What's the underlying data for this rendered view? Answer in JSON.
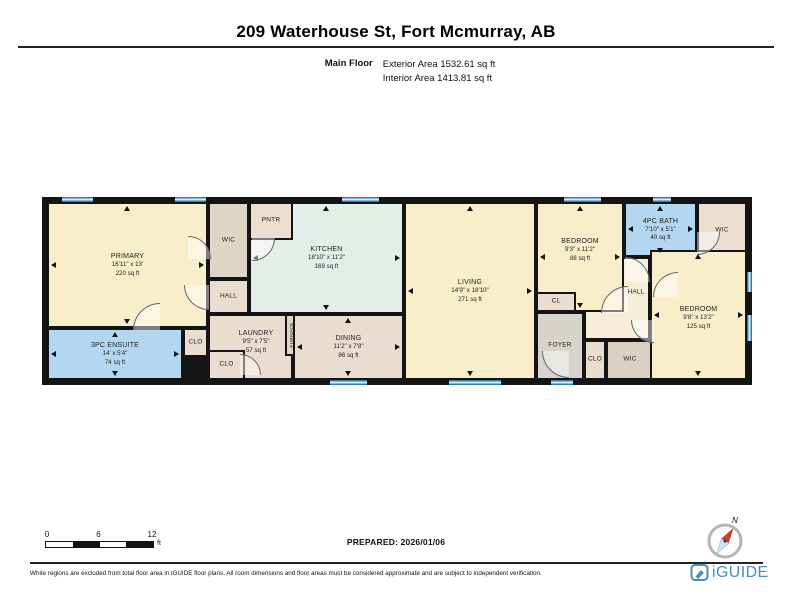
{
  "header": {
    "title": "209 Waterhouse St, Fort Mcmurray, AB",
    "floor_label": "Main Floor",
    "exterior_area": "Exterior Area 1532.61 sq ft",
    "interior_area": "Interior Area 1413.81 sq ft"
  },
  "colors": {
    "cream": "#f8eec9",
    "mint": "#e3eee7",
    "blue": "#b4d7f1",
    "tan": "#e9ddcf",
    "pink_tan": "#ecdfd2",
    "gray": "#d8d3cc",
    "gray_tan": "#ddd5c6",
    "dark_tan": "#d9d2c3",
    "hall_cream": "#f6eed8",
    "wall": "#141414",
    "brand_blue": "#4d8cb8"
  },
  "plan": {
    "rooms": [
      {
        "id": "hall-right",
        "name": "HALL",
        "x": 537,
        "y": 55,
        "w": 66,
        "h": 83,
        "color": "hall_cream",
        "small": true,
        "lcx": 52,
        "lcy": 36
      },
      {
        "id": "kitchen",
        "name": "KITCHEN",
        "dim": "18'10\" x 11'2\"",
        "area": "169 sq ft",
        "x": 202,
        "y": 0,
        "w": 155,
        "h": 112,
        "color": "mint",
        "arrows": true
      },
      {
        "id": "pntr",
        "name": "PNTR",
        "x": 202,
        "y": 0,
        "w": 44,
        "h": 38,
        "color": "pink_tan",
        "small": true
      },
      {
        "id": "primary",
        "name": "PRIMARY",
        "dim": "16'11\" x 13'",
        "area": "220 sq ft",
        "x": 0,
        "y": 0,
        "w": 161,
        "h": 126,
        "color": "cream",
        "arrows": true
      },
      {
        "id": "ensuite",
        "name": "3PC ENSUITE",
        "dim": "14' x 5'4\"",
        "area": "74 sq ft",
        "x": 0,
        "y": 126,
        "w": 136,
        "h": 52,
        "color": "blue",
        "arrows": true
      },
      {
        "id": "clo-1",
        "name": "CLO",
        "x": 136,
        "y": 126,
        "w": 25,
        "h": 29,
        "color": "tan",
        "small": true
      },
      {
        "id": "chase",
        "x": 136,
        "y": 155,
        "w": 25,
        "h": 23,
        "color": "#141414",
        "solid": true
      },
      {
        "id": "wic-left",
        "name": "WIC",
        "x": 161,
        "y": 0,
        "w": 41,
        "h": 77,
        "color": "gray_tan",
        "small": true
      },
      {
        "id": "hall-left",
        "name": "HALL",
        "x": 161,
        "y": 77,
        "w": 41,
        "h": 35,
        "color": "tan",
        "small": true
      },
      {
        "id": "laundry",
        "name": "LAUNDRY",
        "dim": "9'5\" x 7'5\"",
        "area": "57 sq ft",
        "x": 161,
        "y": 112,
        "w": 85,
        "h": 66,
        "color": "tan",
        "lcx": 48,
        "lcy": 28
      },
      {
        "id": "clo-2",
        "name": "CLO",
        "x": 161,
        "y": 148,
        "w": 37,
        "h": 30,
        "color": "tan",
        "small": true
      },
      {
        "id": "furnace",
        "name": "FURNACE",
        "x": 238,
        "y": 112,
        "w": 16,
        "h": 42,
        "color": "gray_tan",
        "vertical": true
      },
      {
        "id": "dining",
        "name": "DINING",
        "dim": "11'2\" x 7'8\"",
        "area": "86 sq ft",
        "x": 246,
        "y": 112,
        "w": 111,
        "h": 66,
        "color": "tan",
        "arrows": true
      },
      {
        "id": "living",
        "name": "LIVING",
        "dim": "14'9\" x 18'10\"",
        "area": "271 sq ft",
        "x": 357,
        "y": 0,
        "w": 132,
        "h": 178,
        "color": "cream",
        "arrows": true
      },
      {
        "id": "bedroom-1",
        "name": "BEDROOM",
        "dim": "9'3\" x 11'2\"",
        "area": "88 sq ft",
        "x": 489,
        "y": 0,
        "w": 88,
        "h": 110,
        "color": "cream",
        "arrows": true,
        "lcy": 48
      },
      {
        "id": "cl",
        "name": "CL",
        "x": 489,
        "y": 90,
        "w": 40,
        "h": 20,
        "color": "tan",
        "small": true
      },
      {
        "id": "foyer",
        "name": "FOYER",
        "x": 489,
        "y": 110,
        "w": 48,
        "h": 68,
        "color": "gray",
        "small": true
      },
      {
        "id": "clo-3",
        "name": "CLO",
        "x": 537,
        "y": 138,
        "w": 22,
        "h": 40,
        "color": "tan",
        "small": true
      },
      {
        "id": "wic-rb",
        "name": "WIC",
        "x": 559,
        "y": 138,
        "w": 48,
        "h": 40,
        "color": "dark_tan",
        "small": true
      },
      {
        "id": "bath",
        "name": "4PC BATH",
        "dim": "7'10\" x 5'1\"",
        "area": "40 sq ft",
        "x": 577,
        "y": 0,
        "w": 73,
        "h": 55,
        "color": "blue",
        "arrows": true
      },
      {
        "id": "wic-tr",
        "name": "WIC",
        "x": 650,
        "y": 0,
        "w": 50,
        "h": 58,
        "color": "pink_tan",
        "small": true
      },
      {
        "id": "bedroom-2",
        "name": "BEDROOM",
        "dim": "9'8\" x 13'2\"",
        "area": "125 sq ft",
        "x": 603,
        "y": 48,
        "w": 97,
        "h": 130,
        "color": "cream",
        "arrows": true,
        "lcy": 68
      }
    ],
    "windows": [
      {
        "side": "top",
        "x": 15,
        "len": 31
      },
      {
        "side": "top",
        "x": 128,
        "len": 31
      },
      {
        "side": "top",
        "x": 295,
        "len": 37
      },
      {
        "side": "top",
        "x": 517,
        "len": 37
      },
      {
        "side": "top",
        "x": 606,
        "len": 18
      },
      {
        "side": "bottom",
        "x": 283,
        "len": 37
      },
      {
        "side": "bottom",
        "x": 402,
        "len": 52
      },
      {
        "side": "bottom",
        "x": 504,
        "len": 22
      },
      {
        "side": "right",
        "y": 70,
        "len": 20
      },
      {
        "side": "right",
        "y": 113,
        "len": 26
      }
    ],
    "doors": [
      {
        "x": 137,
        "y": 83,
        "s": 24,
        "rot": 0
      },
      {
        "x": 86,
        "y": 101,
        "s": 26,
        "rot": 90
      },
      {
        "x": 141,
        "y": 34,
        "s": 22,
        "rot": 180
      },
      {
        "x": 205,
        "y": 36,
        "s": 22,
        "rot": 270
      },
      {
        "x": 193,
        "y": 152,
        "s": 20,
        "rot": 180
      },
      {
        "x": 495,
        "y": 149,
        "s": 26,
        "rot": 0
      },
      {
        "x": 554,
        "y": 84,
        "s": 26,
        "rot": 90
      },
      {
        "x": 578,
        "y": 55,
        "s": 24,
        "rot": 180
      },
      {
        "x": 606,
        "y": 70,
        "s": 24,
        "rot": 90
      },
      {
        "x": 584,
        "y": 118,
        "s": 22,
        "rot": 0
      },
      {
        "x": 650,
        "y": 30,
        "s": 22,
        "rot": 270
      }
    ]
  },
  "scale_bar": {
    "labels": [
      "0",
      "6",
      "12"
    ],
    "unit": "ft"
  },
  "prepared_label": "PREPARED: 2026/01/06",
  "footer": {
    "north_label": "N",
    "disclaimer": "White regions are excluded from total floor area in iGUIDE floor plans. All room dimensions and floor areas must be considered approximate and are subject to independent verification.",
    "brand": "iGUIDE"
  }
}
